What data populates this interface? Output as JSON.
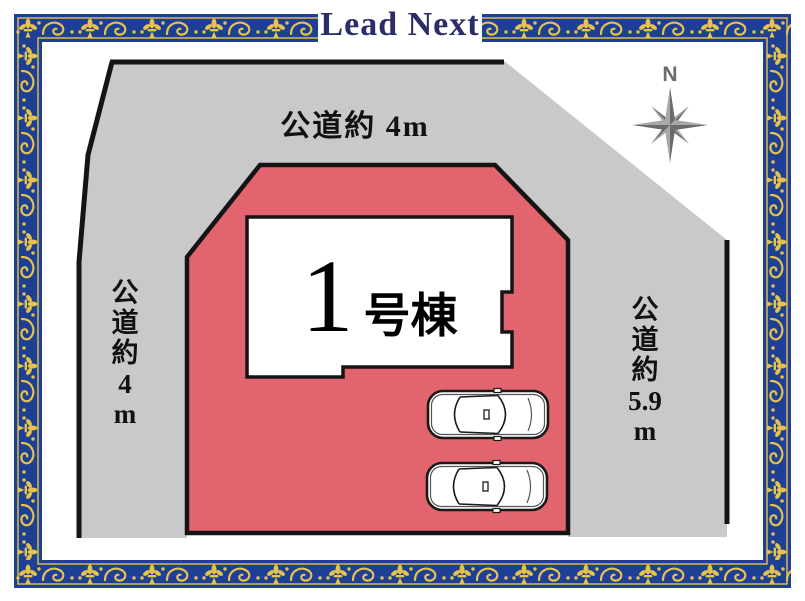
{
  "header": {
    "logo": "Lead Next"
  },
  "compass": {
    "label": "N"
  },
  "site_plan": {
    "top_road_label": "公道約 4m",
    "left_road_label": "公\n道\n約\n4\nm",
    "right_road_label": "公\n道\n約\n5.9\nm",
    "building": {
      "number": "1",
      "suffix": "号棟"
    },
    "cars_count": 2
  },
  "colors": {
    "road_fill": "#c9c9c9",
    "plot_fill": "#e2646e",
    "building_fill": "#ffffff",
    "outline": "#141414",
    "border_blue": "#1d3f94",
    "ornament_gold": "#e8c34a",
    "logo_navy": "#2b2d68",
    "compass_light": "#a9a9a9",
    "compass_dark": "#6b6b6b"
  }
}
